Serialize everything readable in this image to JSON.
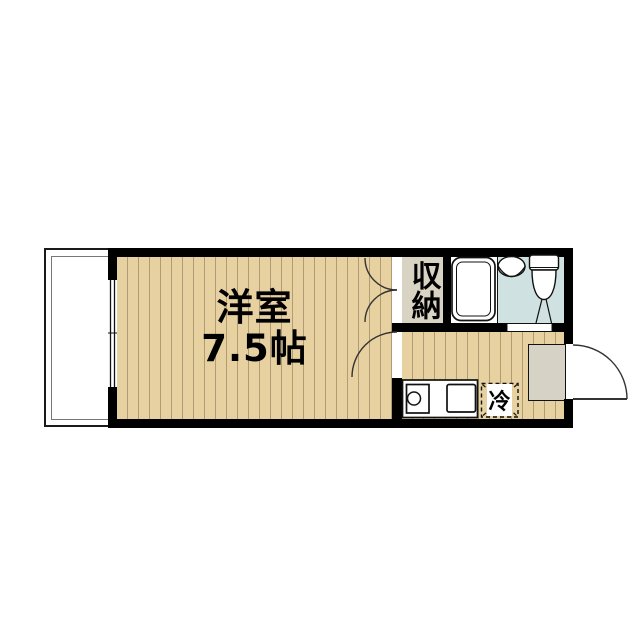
{
  "floorplan": {
    "main_room": {
      "label_line1": "洋室",
      "label_line2": "7.5帖"
    },
    "closet": {
      "label": "収納"
    },
    "refrigerator": {
      "label": "冷"
    },
    "colors": {
      "wall": "#000000",
      "wood_floor": "#e8d1a1",
      "floor_stripe": "#b19b74",
      "closet_floor": "#d9d3c3",
      "bathroom_blue": "#cfe1e0",
      "entry_tile": "#d6d2c6",
      "line": "#111111",
      "door_arc": "#333333"
    }
  }
}
